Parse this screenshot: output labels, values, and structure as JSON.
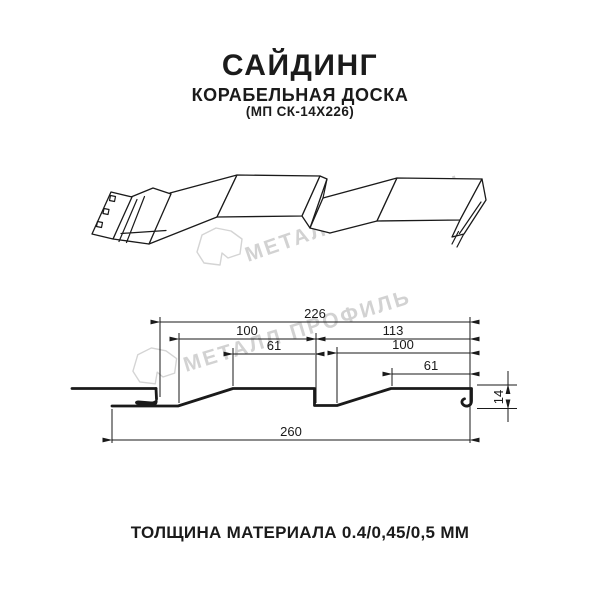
{
  "meta": {
    "background": "#ffffff",
    "line_color": "#1a1a1a",
    "watermark_color": "#d2d2d2"
  },
  "header": {
    "title": "САЙДИНГ",
    "subtitle": "КОРАБЕЛЬНАЯ ДОСКА",
    "model": "(МП СК-14Х226)"
  },
  "watermark": {
    "text": "МЕТАЛЛ ПРОФИЛЬ"
  },
  "dims": {
    "d226": "226",
    "d100l": "100",
    "d61l": "61",
    "d113": "113",
    "d100r": "100",
    "d61r": "61",
    "d260": "260",
    "d14": "14"
  },
  "dimensions_mm": {
    "working_width": 226,
    "overall_width": 260,
    "profile_height": 14,
    "left_segment": {
      "pitch": 100,
      "flat_top": 61
    },
    "right_segment": {
      "span": 113,
      "pitch": 100,
      "flat_top": 61
    }
  },
  "footer": {
    "text": "ТОЛЩИНА МАТЕРИАЛА 0.4/0,45/0,5 ММ"
  }
}
